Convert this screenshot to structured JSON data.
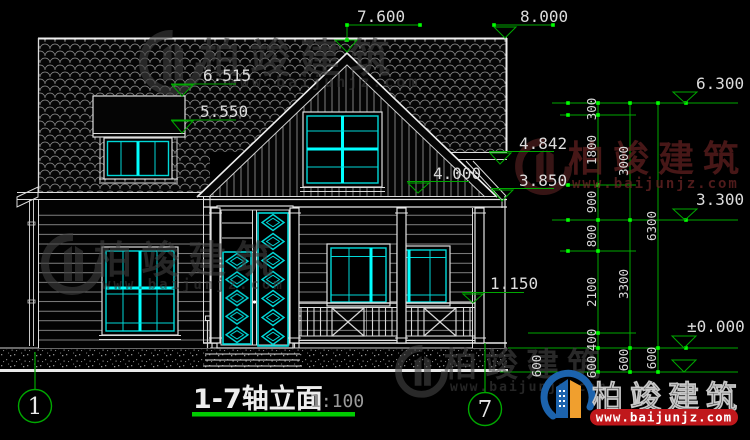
{
  "drawing": {
    "title": "1-7轴立面",
    "scale": "1:100",
    "grid_bubbles": {
      "left": "1",
      "right": "7"
    },
    "levels": {
      "gable_peak": "7.600",
      "ridge": "8.000",
      "dormer_top": "6.515",
      "dormer_eave": "5.550",
      "right_eave_top": "4.842",
      "gable_eave": "4.000",
      "right_eave_bottom": "3.850",
      "railing": "1.150",
      "right_top": "6.300",
      "right_mid": "3.300",
      "ground": "±0.000"
    },
    "dim_chains": {
      "inner": [
        "300",
        "1800",
        "900",
        "800",
        "2100",
        "400",
        "600"
      ],
      "middle": [
        "3000",
        "3300",
        "600"
      ],
      "outer": [
        "6300",
        "600"
      ],
      "base_extra": [
        "600"
      ]
    }
  },
  "watermark": {
    "name": "柏竣建筑",
    "url": "www.baijunjz.com"
  },
  "logo": {
    "name": "柏竣建筑",
    "url": "www.baijunjz.com"
  },
  "colors": {
    "cad_line": "#e8e8e8",
    "cyan": "#00d8d8",
    "cyan_bright": "#00ffff",
    "dim_green": "#00a800",
    "grip_green": "#00ff00",
    "title_green": "#00cc00",
    "logo_blue": "#1c63ad",
    "logo_orange": "#f09f2e",
    "logo_red": "#c0181c",
    "wm_gray": "#454545",
    "wm_red": "#5f1f1f"
  }
}
